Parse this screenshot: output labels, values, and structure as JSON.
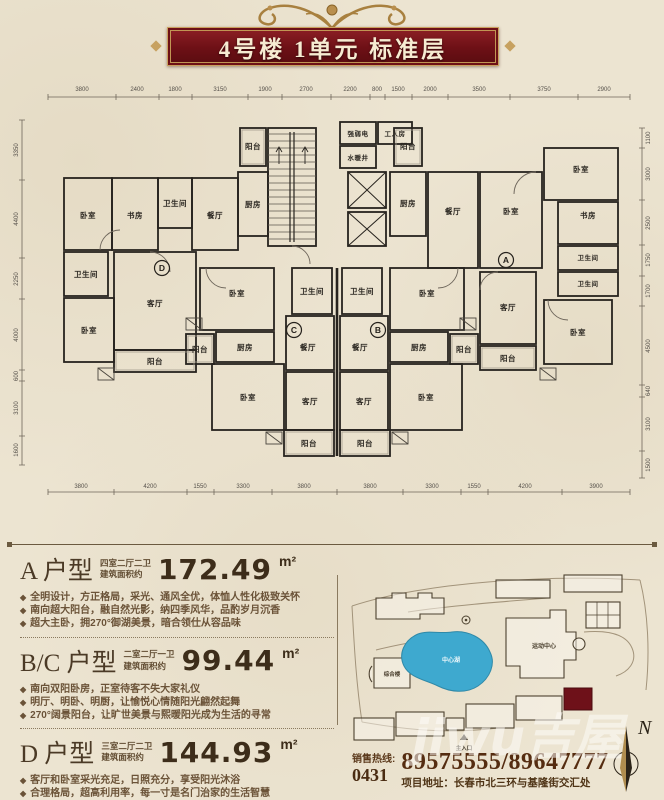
{
  "banner": {
    "title": "4号楼 1单元 标准层"
  },
  "floorplan": {
    "room_names": {
      "bedroom": "卧室",
      "study": "书房",
      "bath": "卫生间",
      "dining": "餐厅",
      "living": "客厅",
      "kitchen": "厨房",
      "balcony": "阳台",
      "worker": "工人房",
      "elec": "强弱电",
      "water": "水暖井"
    },
    "unit_circles": {
      "a": "A",
      "b": "B",
      "c": "C",
      "d": "D"
    },
    "dims_top": [
      "3800",
      "2400",
      "1800",
      "3150",
      "1900",
      "2700",
      "2200",
      "800",
      "1500",
      "2000",
      "3500",
      "3750",
      "2900"
    ],
    "dims_bottom": [
      "3800",
      "4200",
      "1550",
      "3300",
      "3800",
      "3800",
      "3300",
      "1550",
      "4200",
      "3900"
    ],
    "dims_left": [
      "3350",
      "4400",
      "2250",
      "4000",
      "600",
      "3100",
      "1600"
    ],
    "dims_right": [
      "1100",
      "3000",
      "2500",
      "1750",
      "1700",
      "4500",
      "640",
      "3100",
      "1500"
    ]
  },
  "specs": {
    "units": [
      {
        "name": "A 户型",
        "layout": "四室二厅二卫",
        "area_prefix": "建筑面积约",
        "area": "172.49",
        "area_unit": "m²",
        "features": [
          "全明设计，方正格局，采光、通风全优，体恤人性化极致关怀",
          "南向超大阳台，融自然光影，纳四季风华，品酌岁月沉香",
          "超大主卧，拥270°御湖美景，暗合领仕从容品味"
        ]
      },
      {
        "name": "B/C 户型",
        "layout": "二室二厅一卫",
        "area_prefix": "建筑面积约",
        "area": "99.44",
        "area_unit": "m²",
        "features": [
          "南向双阳卧房，正室待客不失大家礼仪",
          "明厅、明卧、明厨，让愉悦心情随阳光翩然起舞",
          "270°阔景阳台，让旷世美景与熙暖阳光成为生活的寻常"
        ]
      },
      {
        "name": "D 户型",
        "layout": "三室二厅二卫",
        "area_prefix": "建筑面积约",
        "area": "144.93",
        "area_unit": "m²",
        "features": [
          "客厅和卧室采光充足，日照充分，享受阳光沐浴",
          "合理格局，超高利用率，每一寸是名门治家的生活智慧",
          "客厅与南向阳台连成一体，恢宏景象匹配大家礼仪"
        ]
      }
    ]
  },
  "siteplan": {
    "lake_label": "中心湖",
    "sports_center_label": "运动中心",
    "complex_label": "综合楼",
    "main_entrance_label": "主入口",
    "north_label": "N"
  },
  "watermark": {
    "text": "jiwu吉屋"
  },
  "contact": {
    "hotline_label": "销售热线:",
    "area_code": "0431",
    "phone_numbers": "89575555/89647777",
    "address": "项目地址：长春市北三环与基隆街交汇处"
  }
}
